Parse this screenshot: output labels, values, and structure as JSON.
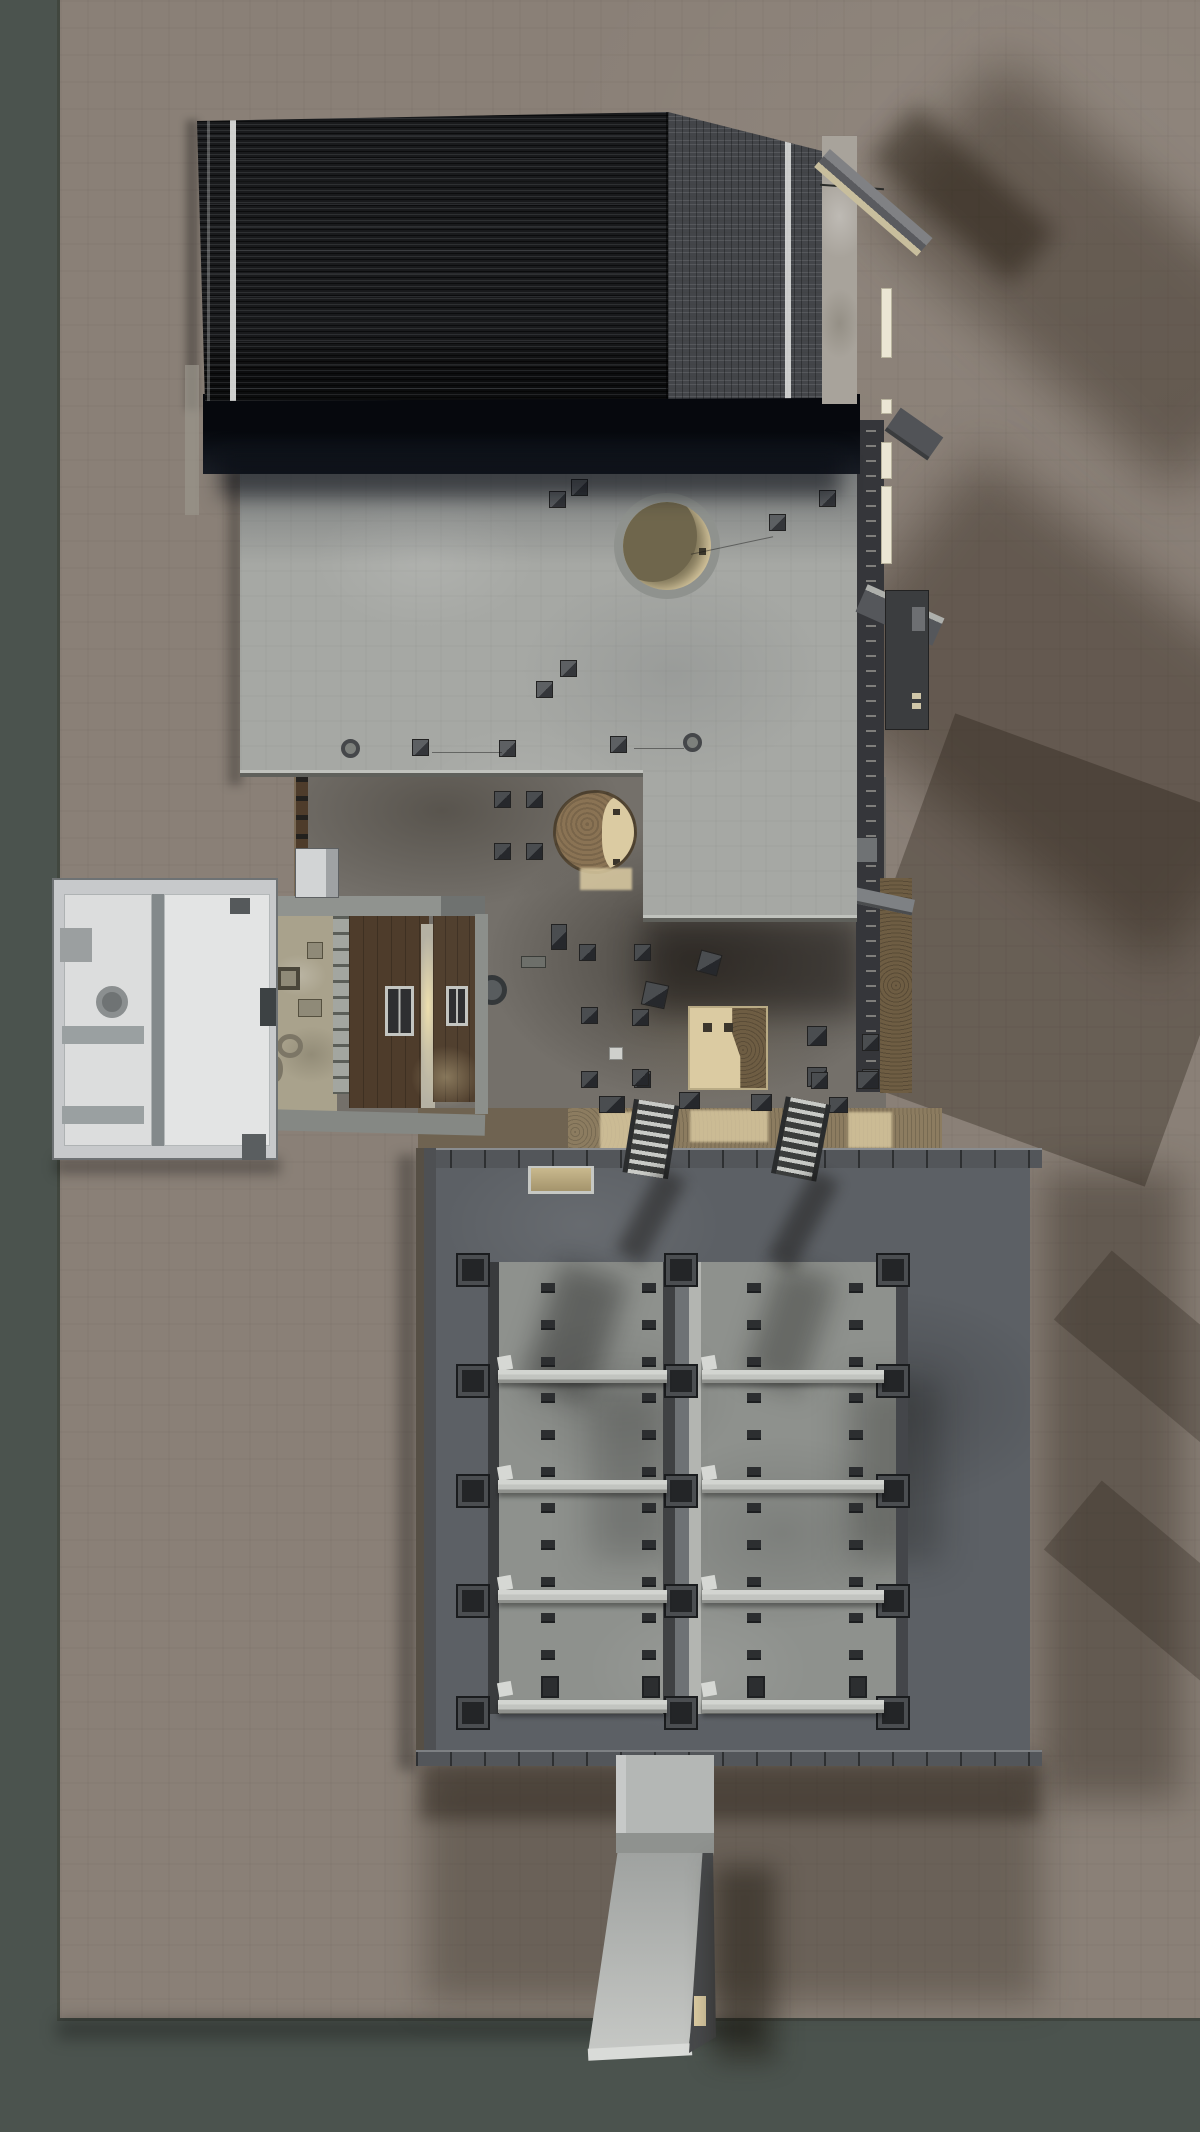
{
  "scene": {
    "description": "Top-down 3D architectural rendering of a concrete building model on a brown ground plane with a dark green backdrop strip",
    "width": 1200,
    "height": 2132
  },
  "labels": {
    "backdrop": "dark green backdrop surface",
    "ground": "brown gravel ground plane",
    "roof": "dark corrugated metal roof",
    "eave": "shadowed roof eave band",
    "slab": "upper concrete floor slab",
    "circle1": "round slab opening with lit lower floor",
    "circle2": "round opening with cork column and lit floor",
    "lower_floor": "shadowed intermediate concrete floor",
    "corridor": "corridor with wooden double doors and warm light",
    "annex": "light gray annex building seen from above",
    "gap_strip": "lit cork-toned ground strip between buildings",
    "stairs": "two steel stairs descending to the storage box",
    "box": "large concrete storage box with shelf racks",
    "pit": "open rack pit with four shelf beams per bay",
    "ramp": "light gray exit ramp at the bottom",
    "right_frame": "steel and concrete frame elements on the east side"
  },
  "palette": {
    "backdrop": "#4b534e",
    "ground": "#8a8077",
    "roof_dark": "#191a1c",
    "roof_light": "#434549",
    "roof_stripe": "#e3e4e2",
    "slab": "#a6a8a4",
    "lower": "#74706a",
    "wood": "#4e3c2b",
    "annex": "#c7c9cb",
    "glow": "#eedfae",
    "box_wall": "#53565a",
    "box_rim": "#5c6065",
    "pit": "#8e918d",
    "beige": "#dbcba2",
    "cork": "#6e5d43",
    "ramp": "#b4b7b5",
    "clip": "#2c2e30"
  },
  "items": [
    {
      "layer": "layer-upper-cubes",
      "class": "cube",
      "name": "concrete-cube",
      "points": [
        [
          560,
          660
        ],
        [
          536,
          681
        ],
        [
          412,
          739
        ],
        [
          499,
          740
        ],
        [
          610,
          736
        ],
        [
          799,
          430
        ],
        [
          819,
          490
        ],
        [
          769,
          514
        ],
        [
          571,
          479
        ],
        [
          549,
          491
        ]
      ]
    },
    {
      "layer": "layer-upper-cubes",
      "class": "knob",
      "name": "pipe-knob",
      "points": [
        [
          341,
          739
        ],
        [
          683,
          733
        ]
      ]
    },
    {
      "layer": "layer-upper-cubes",
      "class": "wire",
      "name": "guy-wire",
      "points": [
        [
          432,
          752,
          70,
          1
        ],
        [
          634,
          748,
          50,
          1
        ],
        [
          690,
          545,
          84,
          1,
          -12
        ]
      ]
    },
    {
      "layer": "layer-lower-cubes",
      "class": "cube cube-lower",
      "name": "concrete-cube",
      "points": [
        [
          494,
          791
        ],
        [
          526,
          791
        ],
        [
          494,
          843
        ],
        [
          526,
          843
        ],
        [
          551,
          924,
          16,
          26
        ],
        [
          579,
          944
        ],
        [
          634,
          944
        ],
        [
          698,
          952,
          22,
          22,
          15
        ],
        [
          643,
          983,
          24,
          24,
          12
        ],
        [
          581,
          1007
        ],
        [
          632,
          1009
        ],
        [
          581,
          1071
        ],
        [
          634,
          1071
        ],
        [
          807,
          1026,
          20,
          20
        ],
        [
          862,
          1034
        ],
        [
          807,
          1067,
          20,
          20
        ],
        [
          862,
          1069
        ],
        [
          632,
          1069
        ],
        [
          679,
          1092,
          21,
          17
        ],
        [
          751,
          1094,
          21,
          17
        ],
        [
          811,
          1072
        ],
        [
          829,
          1097,
          19,
          16
        ],
        [
          857,
          1071,
          22,
          18
        ],
        [
          599,
          1096,
          26,
          17
        ]
      ]
    },
    {
      "layer": "layer-lower-cubes",
      "class": "lbar",
      "name": "low-bar",
      "points": [
        [
          521,
          956,
          25,
          12
        ]
      ]
    },
    {
      "layer": "layer-lower-cubes",
      "class": "wcube",
      "name": "white-cube",
      "points": [
        [
          609,
          1047,
          14,
          13
        ]
      ]
    },
    {
      "layer": "layer-east",
      "class": "epanel",
      "name": "wall-light-panel",
      "points": [
        [
          881,
          288,
          11,
          70
        ],
        [
          881,
          399,
          11,
          15
        ],
        [
          881,
          442,
          11,
          37
        ],
        [
          881,
          486,
          11,
          78
        ]
      ]
    },
    {
      "layer": "layer-fittings",
      "class": "tab",
      "name": "shelf-end-tab",
      "points": [
        [
          498,
          1356
        ],
        [
          702,
          1356
        ],
        [
          498,
          1466
        ],
        [
          702,
          1466
        ],
        [
          498,
          1576
        ],
        [
          702,
          1576
        ],
        [
          498,
          1682
        ],
        [
          702,
          1682
        ]
      ]
    }
  ],
  "grids": [
    {
      "layer": "layer-fittings",
      "class": "stud",
      "name": "corner-stud",
      "cols": [
        458,
        666,
        878
      ],
      "rows": [
        1255,
        1366,
        1476,
        1586,
        1698
      ]
    },
    {
      "layer": "layer-fittings",
      "class": "clip",
      "name": "rack-clip",
      "cols": [
        541,
        642,
        747,
        849
      ],
      "rows": [
        1283,
        1320,
        1357,
        1393,
        1430,
        1467,
        1503,
        1540,
        1577,
        1613,
        1650
      ]
    },
    {
      "layer": "layer-fittings",
      "class": "clip-big",
      "name": "rack-clip-large",
      "cols": [
        541,
        642,
        747,
        849
      ],
      "rows": [
        1676
      ]
    }
  ],
  "beams": {
    "layer": "layer-fittings",
    "class": "shelf",
    "name": "shelf-beam",
    "bays": [
      [
        498,
        667
      ],
      [
        702,
        884
      ]
    ],
    "ys": [
      1370,
      1480,
      1590,
      1700
    ],
    "h": 13
  }
}
